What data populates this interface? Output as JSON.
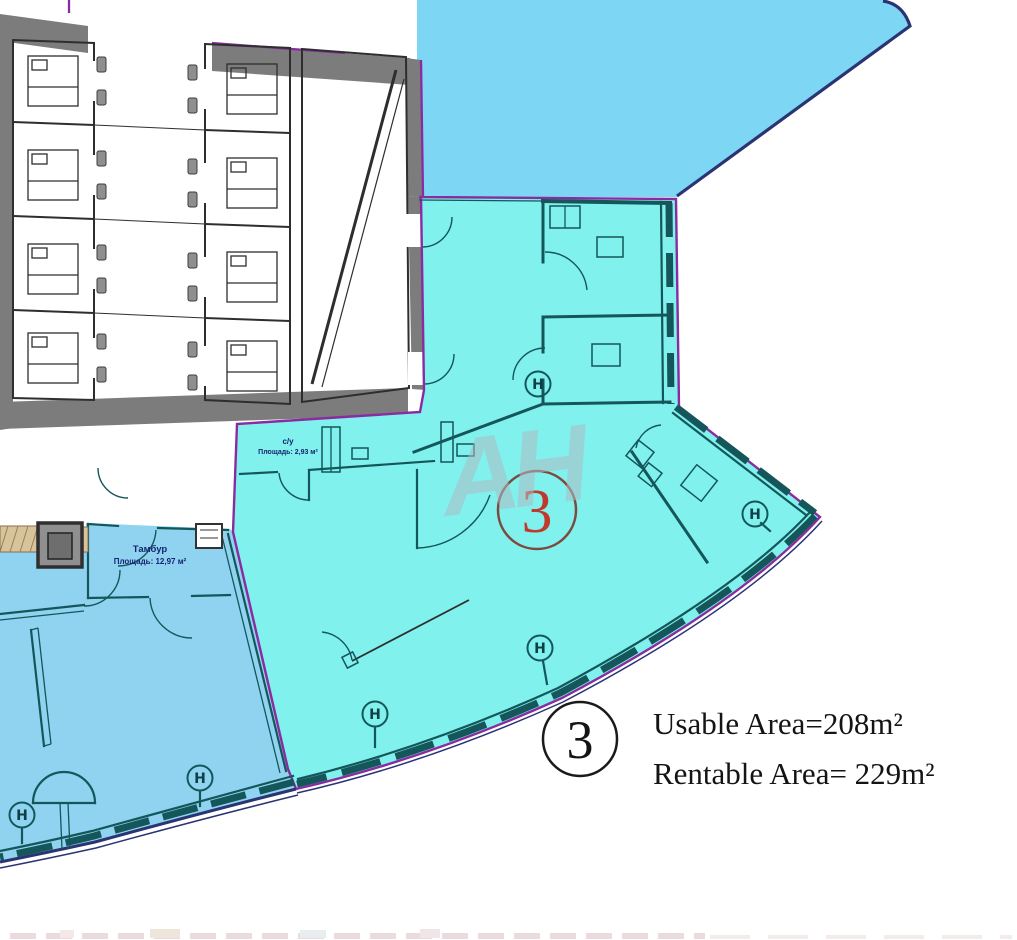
{
  "plan": {
    "watermark": "AH",
    "unit_badge": "3",
    "radiator": "H",
    "legend": {
      "number": "3",
      "usable": "Usable Area=208m²",
      "rentable": "Rentable Area= 229m²"
    },
    "vestibule": {
      "title": "Тамбур",
      "area": "Площадь: 12,97 м²"
    },
    "wc": {
      "title": "с/у",
      "area": "Площадь: 2,93 м²"
    },
    "colors": {
      "unit": "#80F1ED",
      "neighbor": "#7DD6F3",
      "adjacent": "#8FD3F0",
      "boundary": "#8A2BA0",
      "wall": "#14565A",
      "red": "#BF392C"
    }
  }
}
